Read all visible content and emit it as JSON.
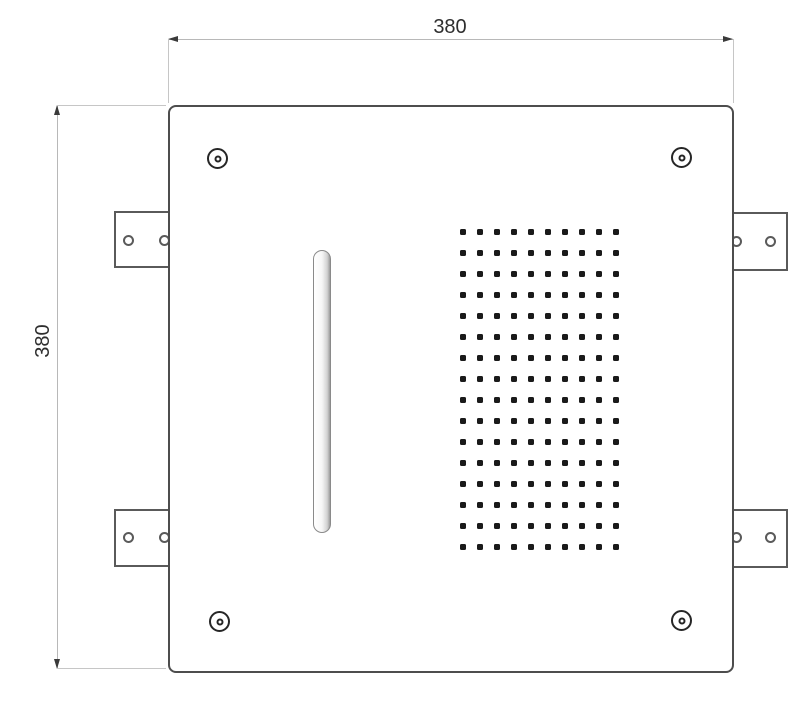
{
  "drawing": {
    "kind": "technical dimension drawing",
    "dimensions": {
      "width_label": "380",
      "height_label": "380"
    },
    "nozzle_grid": {
      "rows": 16,
      "cols": 10
    },
    "features": {
      "corner_screws": 4,
      "mounting_brackets": 4,
      "bracket_holes_per_bracket": 2,
      "slot": "vertical waterfall slot"
    },
    "colors": {
      "outline": "#4d4d4d",
      "bracket": "#5a5a5a",
      "dim_line": "#b8b8b8",
      "ext_line": "#c6c6c6",
      "arrow": "#3a3a3a",
      "text": "#2e2e2e",
      "dot": "#1a1a1a",
      "screw": "#262626"
    }
  }
}
